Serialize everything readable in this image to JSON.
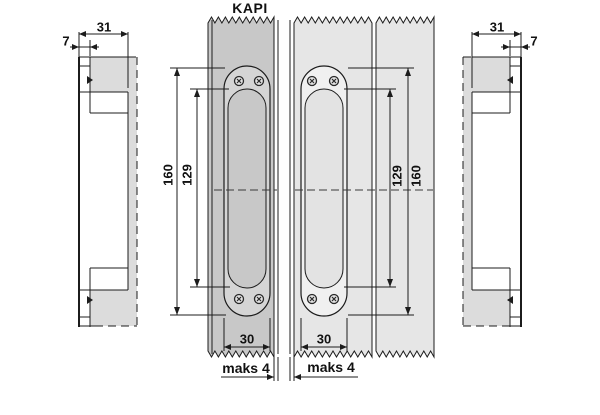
{
  "drawing": {
    "title": "KAPI",
    "side_view_left": {
      "depth_total": "31",
      "lip_depth": "7"
    },
    "side_view_right": {
      "depth_total": "31",
      "lip_depth": "7"
    },
    "front_view_door1": {
      "plate_height": "160",
      "recess_height": "129",
      "plate_width": "30",
      "edge_gap": "maks 4"
    },
    "front_view_door2": {
      "plate_height": "160",
      "recess_height": "129",
      "plate_width": "30",
      "edge_gap": "maks 4"
    },
    "colors": {
      "line": "#1c1c1c",
      "text": "#111111",
      "door1": "#c8c8c8",
      "door2": "#e6e6e6",
      "side": "#dcdcdc",
      "plate1": "#d5d5d5",
      "plate2": "#f0f0f0",
      "recess1": "#c8c8c8",
      "recess2": "#e3e3e3"
    }
  }
}
